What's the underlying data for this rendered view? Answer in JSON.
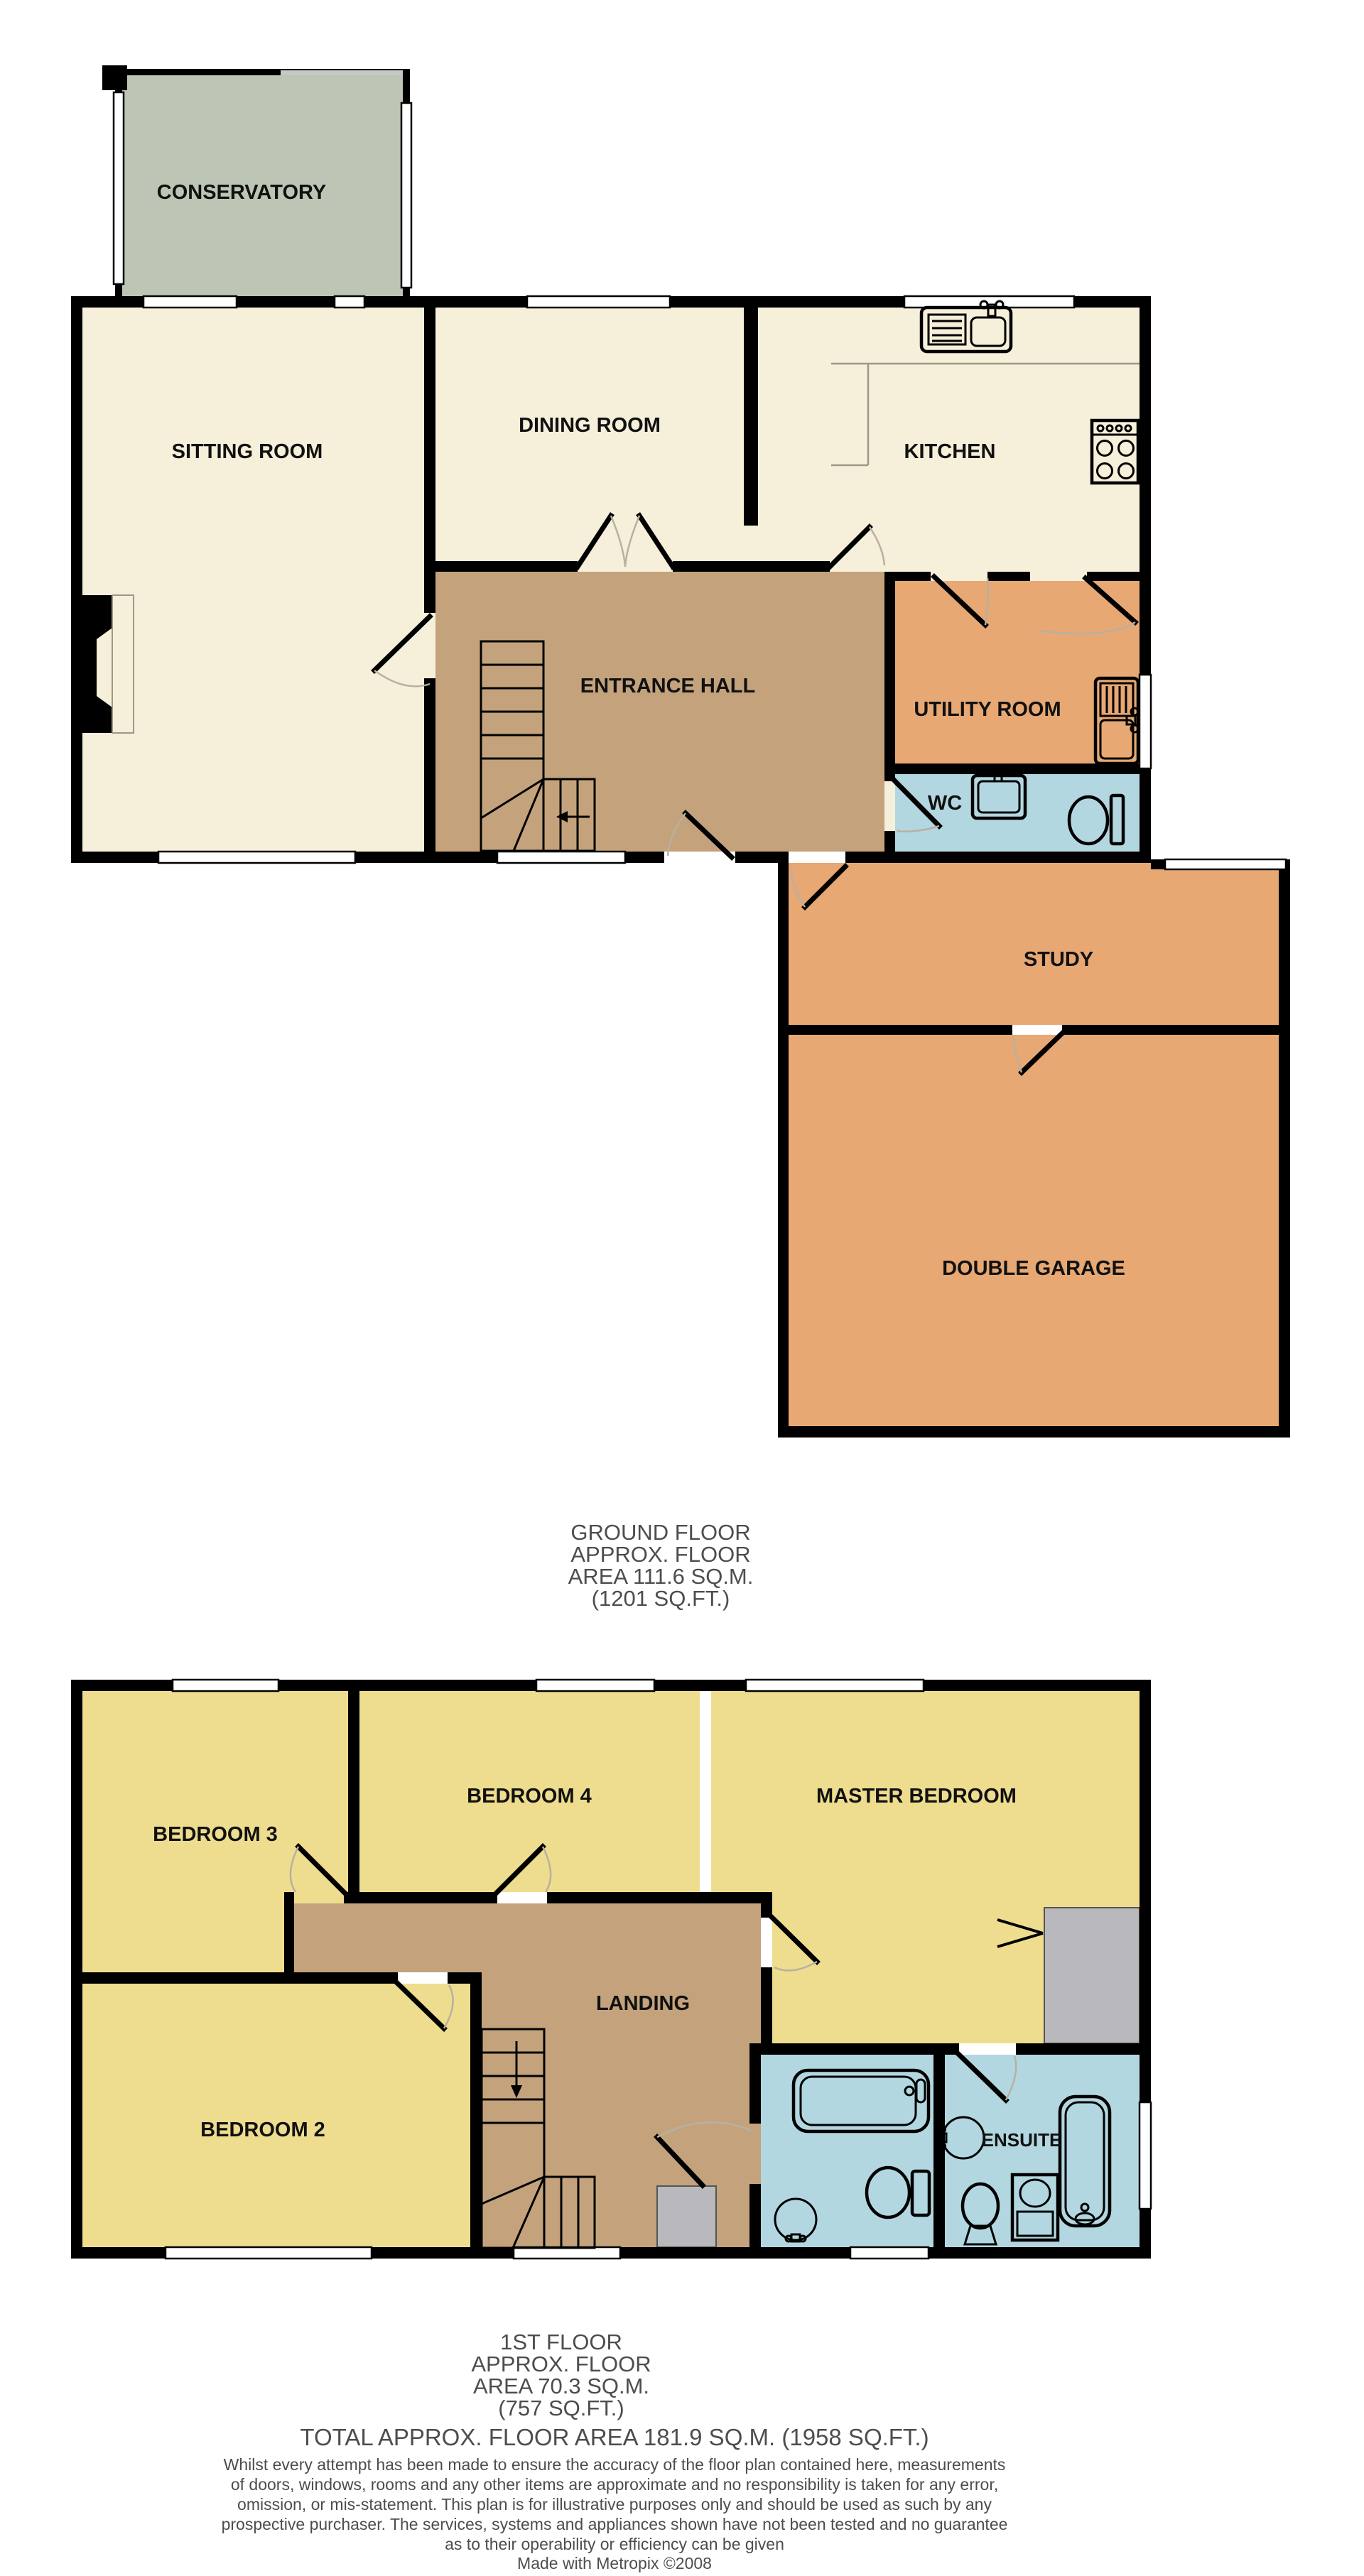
{
  "colors": {
    "wall": "#000000",
    "cream_room": "#f6efd9",
    "hall_landing": "#c4a37c",
    "orange_room": "#e7a873",
    "wet_room_blue": "#b3d7e0",
    "bedroom_yellow": "#eedd8e",
    "conservatory_green": "#bdc6b5",
    "cupboard_gray": "#b9b9bd",
    "window": "#ffffff",
    "label_text": "#111111",
    "footer_text": "#4d4d4d"
  },
  "ground_floor": {
    "rooms": {
      "conservatory": "CONSERVATORY",
      "sitting_room": "SITTING ROOM",
      "dining_room": "DINING ROOM",
      "kitchen": "KITCHEN",
      "entrance_hall": "ENTRANCE HALL",
      "utility_room": "UTILITY ROOM",
      "wc": "WC",
      "study": "STUDY",
      "double_garage": "DOUBLE GARAGE"
    },
    "caption": [
      "GROUND FLOOR",
      "APPROX. FLOOR",
      "AREA 111.6 SQ.M.",
      "(1201 SQ.FT.)"
    ]
  },
  "first_floor": {
    "rooms": {
      "bedroom_3": "BEDROOM 3",
      "bedroom_4": "BEDROOM 4",
      "master_bedroom": "MASTER BEDROOM",
      "landing": "LANDING",
      "bedroom_2": "BEDROOM 2",
      "ensuite": "ENSUITE"
    },
    "caption": [
      "1ST FLOOR",
      "APPROX. FLOOR",
      "AREA 70.3 SQ.M.",
      "(757 SQ.FT.)"
    ]
  },
  "footer": {
    "total": "TOTAL APPROX. FLOOR AREA 181.9 SQ.M. (1958 SQ.FT.)",
    "disclaimer": [
      "Whilst every attempt has been made to ensure the accuracy of the floor plan contained here, measurements",
      "of doors, windows, rooms and any other items are approximate and no responsibility is taken for any error,",
      "omission, or mis-statement. This plan is for illustrative purposes only and should be used as such by any",
      "prospective purchaser. The services, systems and appliances shown have not been tested and no guarantee",
      "as to their operability or efficiency can be given"
    ],
    "credit": "Made with Metropix ©2008"
  }
}
